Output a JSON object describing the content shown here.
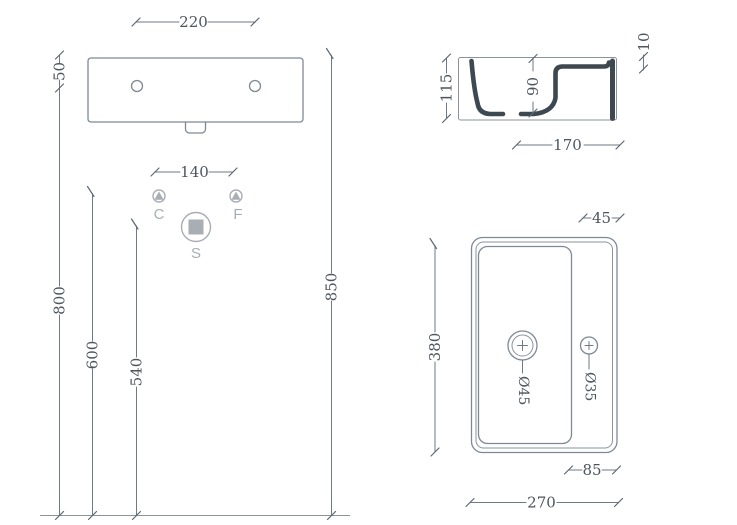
{
  "front_view": {
    "dims": {
      "top_width": "220",
      "hole_spacing": "140",
      "rim_to_holes": "50",
      "holes_height": "800",
      "supply_height": "600",
      "drain_height": "540",
      "overall_height": "850"
    },
    "symbols": {
      "c": "C",
      "f": "F",
      "s": "S"
    }
  },
  "side_view": {
    "dims": {
      "height": "115",
      "inner_depth": "90",
      "rim_thickness": "10",
      "depth": "170"
    }
  },
  "plan_view": {
    "dims": {
      "deck_width": "45",
      "length": "380",
      "drain_diameter": "Ø45",
      "hole_diameter": "Ø35",
      "hole_offset": "85",
      "width": "270"
    }
  },
  "colors": {
    "geometry_line": "#7e8995",
    "section_cut": "#3e4850",
    "dimension_text": "#4d555d",
    "symbol_gray": "#a9aeb5",
    "background": "#ffffff"
  }
}
